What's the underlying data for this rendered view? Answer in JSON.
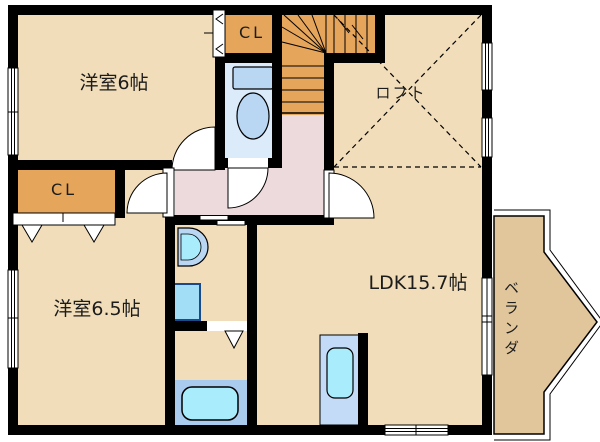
{
  "plan": {
    "rooms": {
      "bedroom_top": {
        "label": "洋室6帖"
      },
      "bedroom_bottom": {
        "label": "洋室6.5帖"
      },
      "ldk": {
        "label": "LDK15.7帖"
      },
      "loft": {
        "label": "ロフト"
      },
      "veranda": {
        "label": "ベランダ"
      },
      "closet_top": {
        "label": "CL"
      },
      "closet_side": {
        "label": "CL"
      }
    },
    "colors": {
      "wall": "#000000",
      "room_floor": "#f1ddb9",
      "hall_floor": "#eddadd",
      "closet_and_stairs_floor": "#e5a55b",
      "toilet_floor": "#dcebfa",
      "bath_floor": "#a8cbee",
      "fixture_light_blue": "#b9d6f3",
      "fixture_cyan": "#a9ecfb",
      "kitchen_counter": "#c3dbf6",
      "veranda_floor": "#e2c69b",
      "opening_white": "#ffffff"
    }
  }
}
